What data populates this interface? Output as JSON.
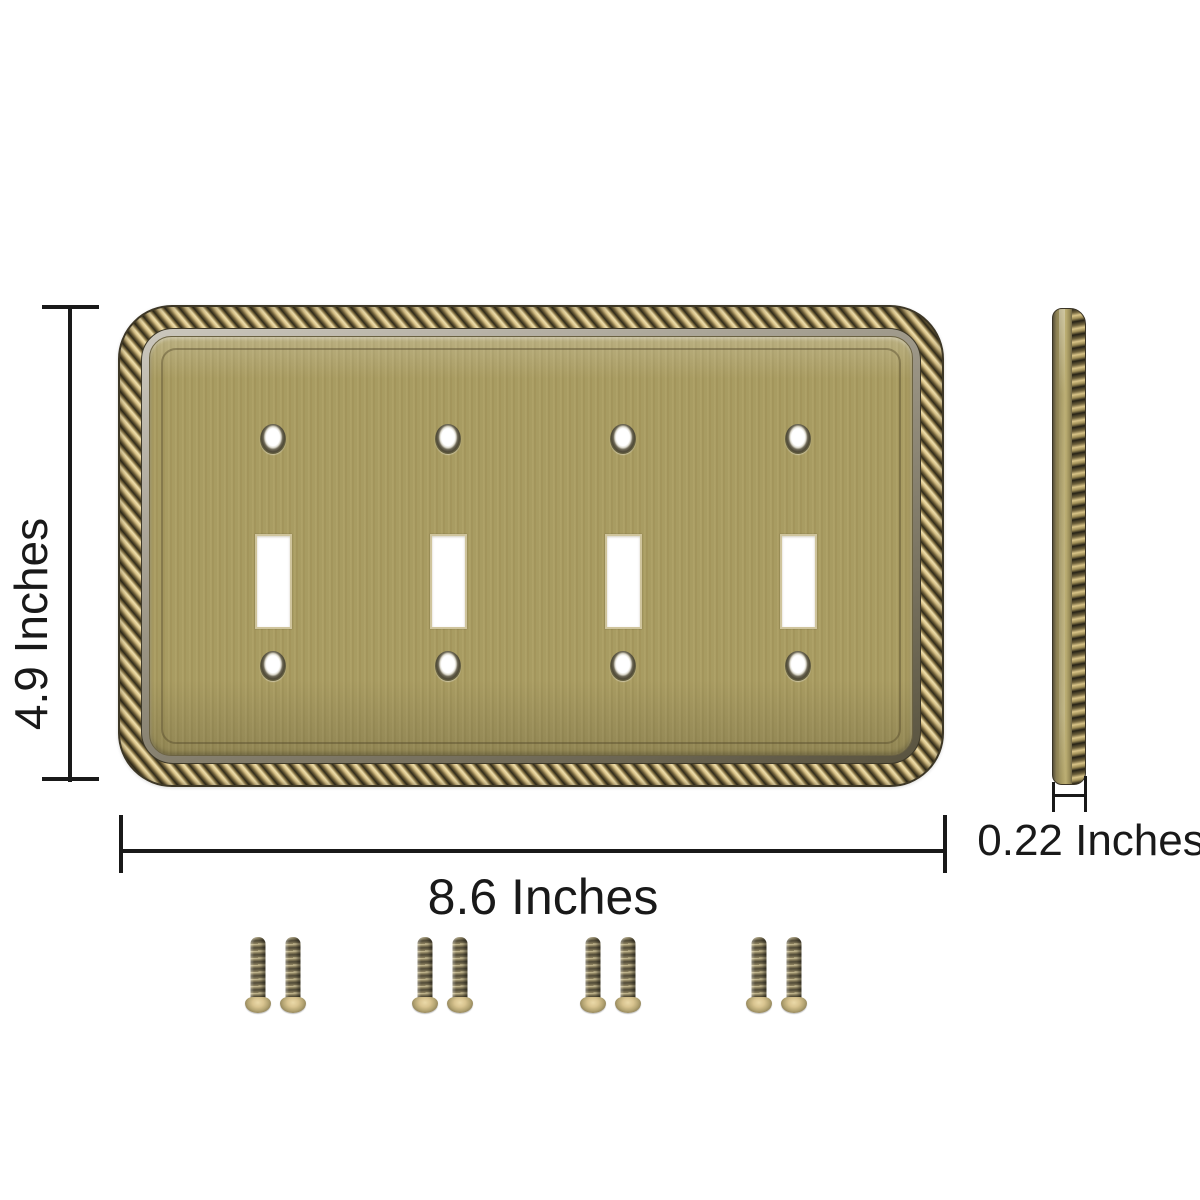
{
  "page": {
    "type": "product-dimension-diagram",
    "background": "#ffffff"
  },
  "dimensions": {
    "height_label": "4.9 Inches",
    "width_label": "8.6 Inches",
    "depth_label": "0.22 Inches"
  },
  "front_view": {
    "toggle_cutout_count": 4,
    "screw_hole_count": 8
  },
  "hardware": {
    "screw_count": 8,
    "screw_pairs": 4
  },
  "colors": {
    "dimension_ink": "#191919",
    "brass_face": "#a89b61",
    "rope_gold": "#d9c288",
    "rope_shadow": "#2e2919",
    "bevel_gray": "#a7a296",
    "screw_brass": "#b5a573"
  }
}
